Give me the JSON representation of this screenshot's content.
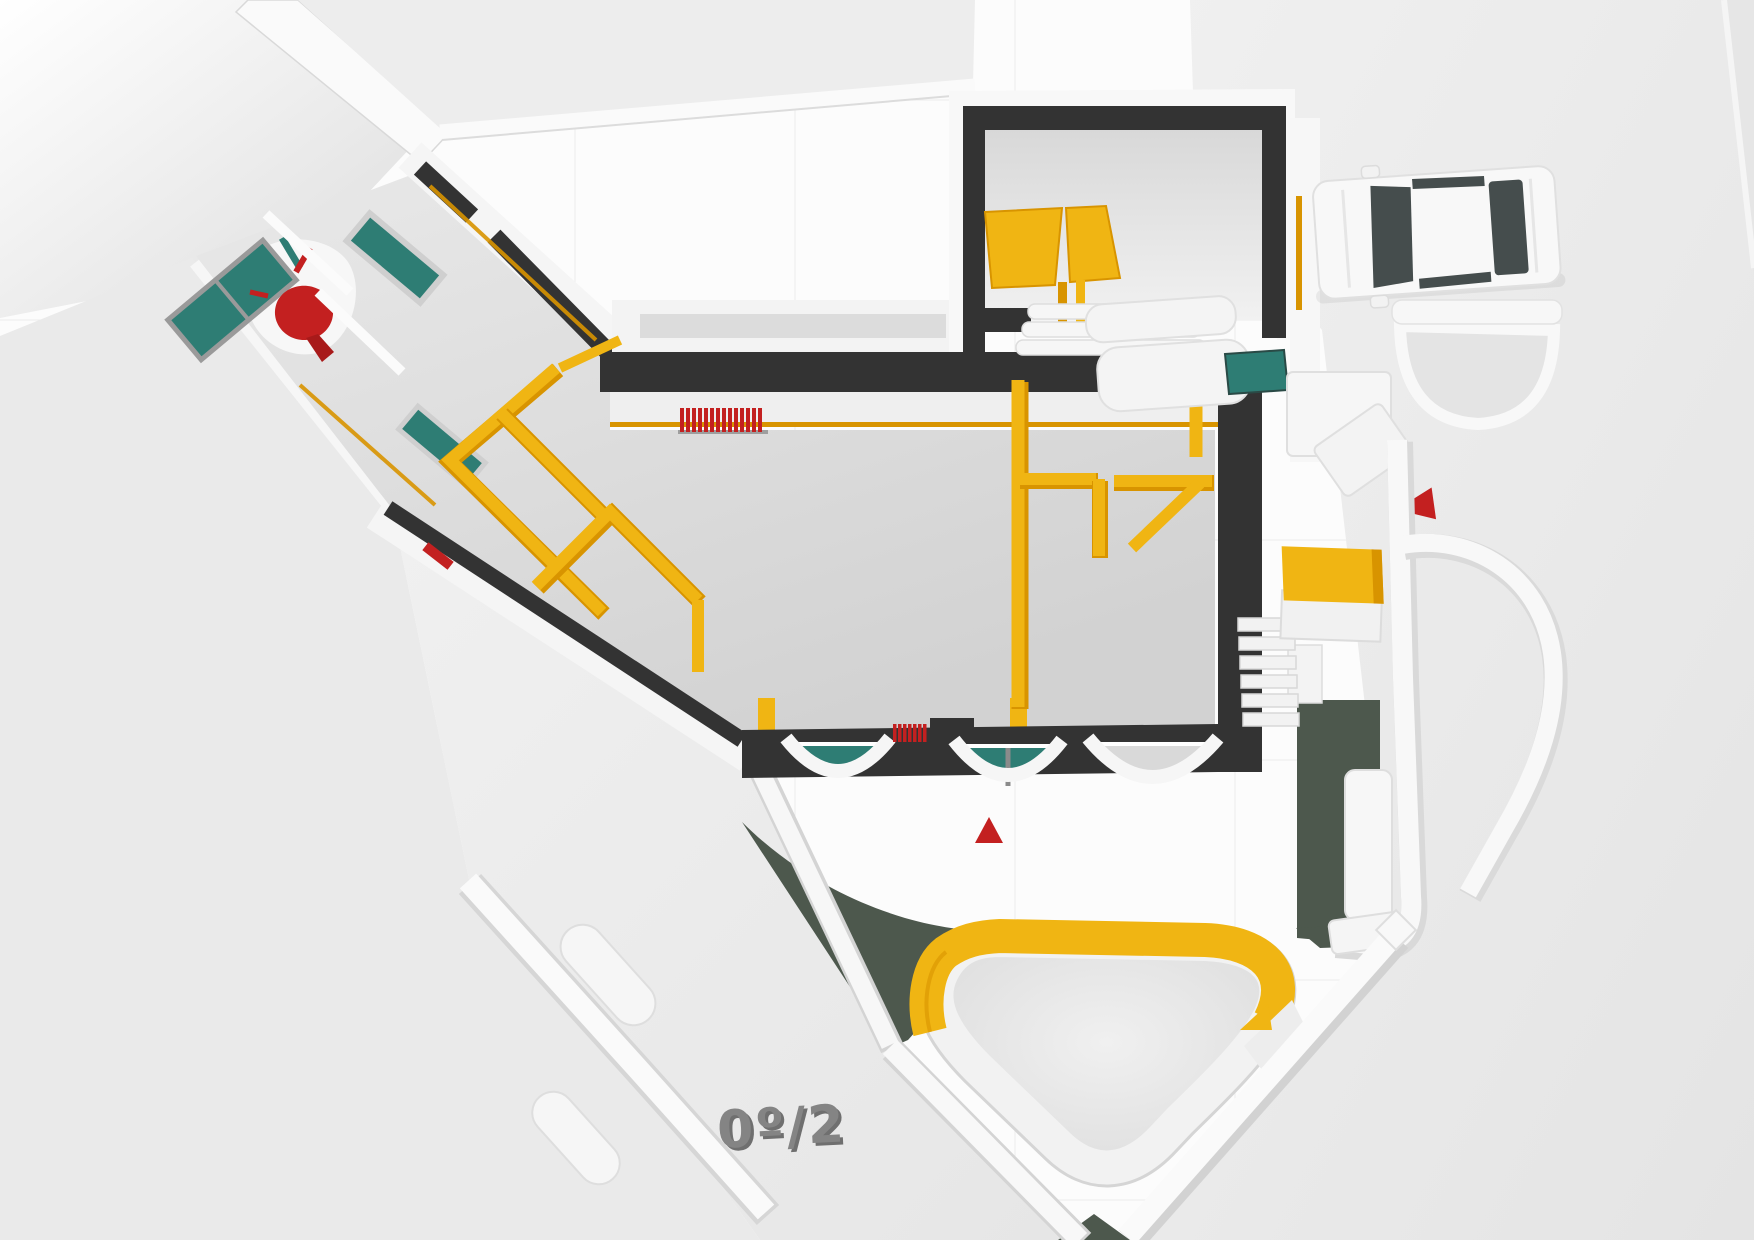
{
  "scene": {
    "floor_label": "0º/2",
    "colors": {
      "bg": "#fbfbfb",
      "ground": "#e9e9e9",
      "ground_light": "#f3f3f3",
      "floor": "#d9d9d9",
      "wall_dark": "#333333",
      "wall_white": "#f7f7f7",
      "wall_edge": "#d6d6d6",
      "yellow": "#f0b513",
      "yellow_edge": "#d89400",
      "teal": "#2e7d74",
      "green": "#4d584d",
      "red": "#c32020",
      "glass": "#454d4d",
      "label_gray": "#848484"
    }
  }
}
